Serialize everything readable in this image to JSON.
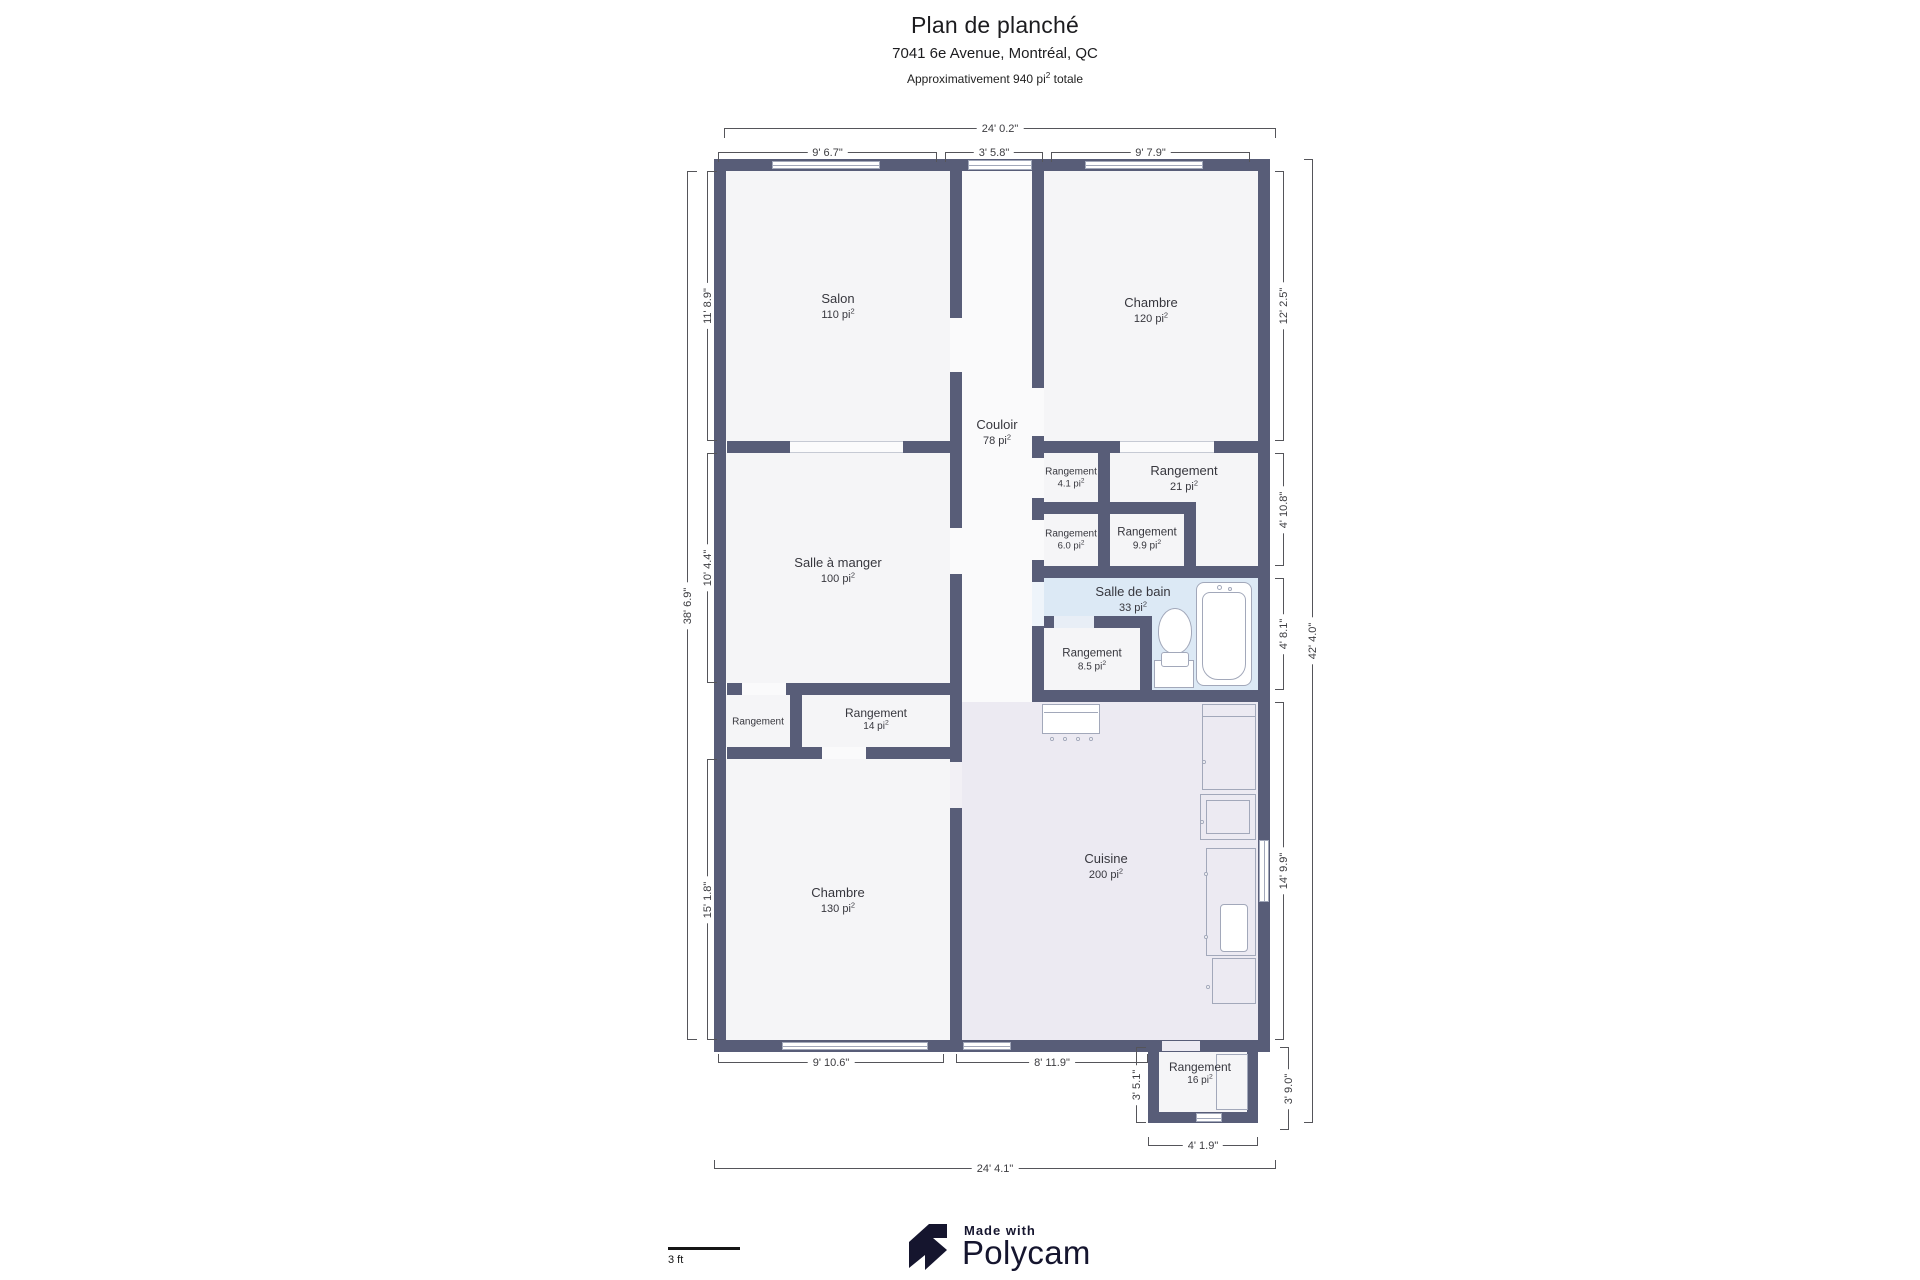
{
  "header": {
    "title": "Plan de planché",
    "subtitle": "7041 6e Avenue, Montréal, QC",
    "approx_prefix": "Approximativement 940 pi",
    "approx_suffix": " totale"
  },
  "sup": "2",
  "rooms": {
    "salon": {
      "name": "Salon",
      "area": "110 pi"
    },
    "chambre_haut": {
      "name": "Chambre",
      "area": "120 pi"
    },
    "couloir": {
      "name": "Couloir",
      "area": "78 pi"
    },
    "salle_a_manger": {
      "name": "Salle à manger",
      "area": "100 pi"
    },
    "chambre_bas": {
      "name": "Chambre",
      "area": "130 pi"
    },
    "cuisine": {
      "name": "Cuisine",
      "area": "200 pi"
    },
    "salle_de_bain": {
      "name": "Salle de bain",
      "area": "33 pi"
    },
    "rangement_4_1": {
      "name": "Rangement",
      "area": "4.1 pi"
    },
    "rangement_21": {
      "name": "Rangement",
      "area": "21 pi"
    },
    "rangement_6_0": {
      "name": "Rangement",
      "area": "6.0 pi"
    },
    "rangement_9_9": {
      "name": "Rangement",
      "area": "9.9 pi"
    },
    "rangement_8_5": {
      "name": "Rangement",
      "area": "8.5 pi"
    },
    "rangement_gauche": {
      "name": "Rangement"
    },
    "rangement_14": {
      "name": "Rangement",
      "area": "14 pi"
    },
    "rangement_16": {
      "name": "Rangement",
      "area": "16 pi"
    }
  },
  "dimensions": {
    "top_total": "24' 0.2\"",
    "top_salon": "9' 6.7\"",
    "top_couloir": "3' 5.8\"",
    "top_chambre": "9' 7.9\"",
    "left_total": "38' 6.9\"",
    "left_salon": "11' 8.9\"",
    "left_salle_a_manger": "10' 4.4\"",
    "left_chambre": "15' 1.8\"",
    "right_total": "42' 4.0\"",
    "right_chambre": "12' 2.5\"",
    "right_rangement": "4' 10.8\"",
    "right_salle_de_bain": "4' 8.1\"",
    "right_cuisine": "14' 9.9\"",
    "right_annexe": "3' 9.0\"",
    "bottom_chambre": "9' 10.6\"",
    "bottom_cuisine": "8' 11.9\"",
    "bottom_annexe_cote": "3' 5.1\"",
    "bottom_annexe": "4' 1.9\"",
    "bottom_total": "24' 4.1\""
  },
  "footer": {
    "made_with": "Made with",
    "brand": "Polycam",
    "scale_label": "3 ft"
  },
  "colors": {
    "wall": "#585d78",
    "floor": "#f5f5f7",
    "bathroom_floor": "#dce9f5",
    "kitchen_floor": "#eceaf2",
    "fixture_line": "#a2a8ba",
    "dimension_line": "#55555a",
    "brand_navy": "#15152e"
  }
}
